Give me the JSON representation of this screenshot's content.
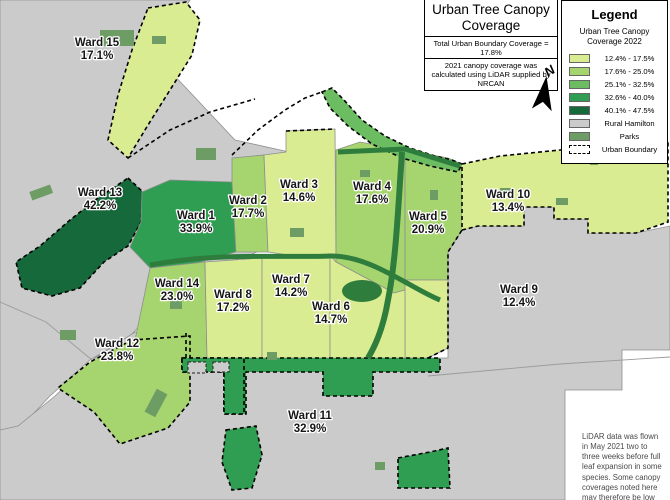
{
  "title_panel": {
    "title": "Urban Tree Canopy Coverage",
    "subtitle": "Total Urban Boundary Coverage = 17.8%",
    "note": "2021 canopy coverage was calculated using LiDAR supplied by NRCAN"
  },
  "legend": {
    "title": "Legend",
    "subtitle": "Urban Tree Canopy Coverage 2022",
    "items": [
      {
        "label": "12.4% - 17.5%",
        "band": "b1",
        "color": "#d9ec92"
      },
      {
        "label": "17.6% - 25.0%",
        "band": "b2",
        "color": "#a6d46e"
      },
      {
        "label": "25.1% - 32.5%",
        "band": "b3",
        "color": "#6cbd62"
      },
      {
        "label": "32.6% - 40.0%",
        "band": "b4",
        "color": "#2f9e52"
      },
      {
        "label": "40.1% - 47.5%",
        "band": "b5",
        "color": "#15693a"
      },
      {
        "label": "Rural Hamilton",
        "band": "rural",
        "color": "#cbcbcb"
      },
      {
        "label": "Parks",
        "band": "parks",
        "color": "#6d9d64"
      },
      {
        "label": "Urban Boundary",
        "style": "dashed"
      }
    ]
  },
  "north_label": "N",
  "map_note": "LiDAR data was flown in May 2021 two to three weeks before full leaf expansion in some species. Some canopy coverages noted here may therefore be low",
  "palette": {
    "b1": "#d9ec92",
    "b2": "#a6d46e",
    "b3": "#6cbd62",
    "b4": "#2f9e52",
    "b5": "#15693a",
    "rural": "#cbcbcb",
    "parks": "#6d9d64",
    "valley": "#2e7d3d",
    "water": "#ffffff"
  },
  "wards": [
    {
      "id": "ward-15",
      "name": "Ward 15",
      "value": "17.1%",
      "band": "b1",
      "x": 97,
      "y": 46
    },
    {
      "id": "ward-13",
      "name": "Ward 13",
      "value": "42.2%",
      "band": "b5",
      "x": 100,
      "y": 196
    },
    {
      "id": "ward-1",
      "name": "Ward 1",
      "value": "33.9%",
      "band": "b4",
      "x": 196,
      "y": 219
    },
    {
      "id": "ward-2",
      "name": "Ward 2",
      "value": "17.7%",
      "band": "b2",
      "x": 248,
      "y": 204
    },
    {
      "id": "ward-3",
      "name": "Ward 3",
      "value": "14.6%",
      "band": "b1",
      "x": 299,
      "y": 188
    },
    {
      "id": "ward-4",
      "name": "Ward 4",
      "value": "17.6%",
      "band": "b2",
      "x": 372,
      "y": 190
    },
    {
      "id": "ward-5",
      "name": "Ward 5",
      "value": "20.9%",
      "band": "b2",
      "x": 428,
      "y": 220
    },
    {
      "id": "ward-10",
      "name": "Ward 10",
      "value": "13.4%",
      "band": "b1",
      "x": 508,
      "y": 198
    },
    {
      "id": "ward-9",
      "name": "Ward 9",
      "value": "12.4%",
      "band": "b1",
      "x": 519,
      "y": 293
    },
    {
      "id": "ward-14",
      "name": "Ward 14",
      "value": "23.0%",
      "band": "b2",
      "x": 177,
      "y": 287
    },
    {
      "id": "ward-8",
      "name": "Ward 8",
      "value": "17.2%",
      "band": "b1",
      "x": 233,
      "y": 298
    },
    {
      "id": "ward-7",
      "name": "Ward 7",
      "value": "14.2%",
      "band": "b1",
      "x": 291,
      "y": 283
    },
    {
      "id": "ward-6",
      "name": "Ward 6",
      "value": "14.7%",
      "band": "b1",
      "x": 331,
      "y": 310
    },
    {
      "id": "ward-12",
      "name": "Ward 12",
      "value": "23.8%",
      "band": "b2",
      "x": 117,
      "y": 347
    },
    {
      "id": "ward-11",
      "name": "Ward 11",
      "value": "32.9%",
      "band": "b4",
      "x": 310,
      "y": 419
    }
  ]
}
